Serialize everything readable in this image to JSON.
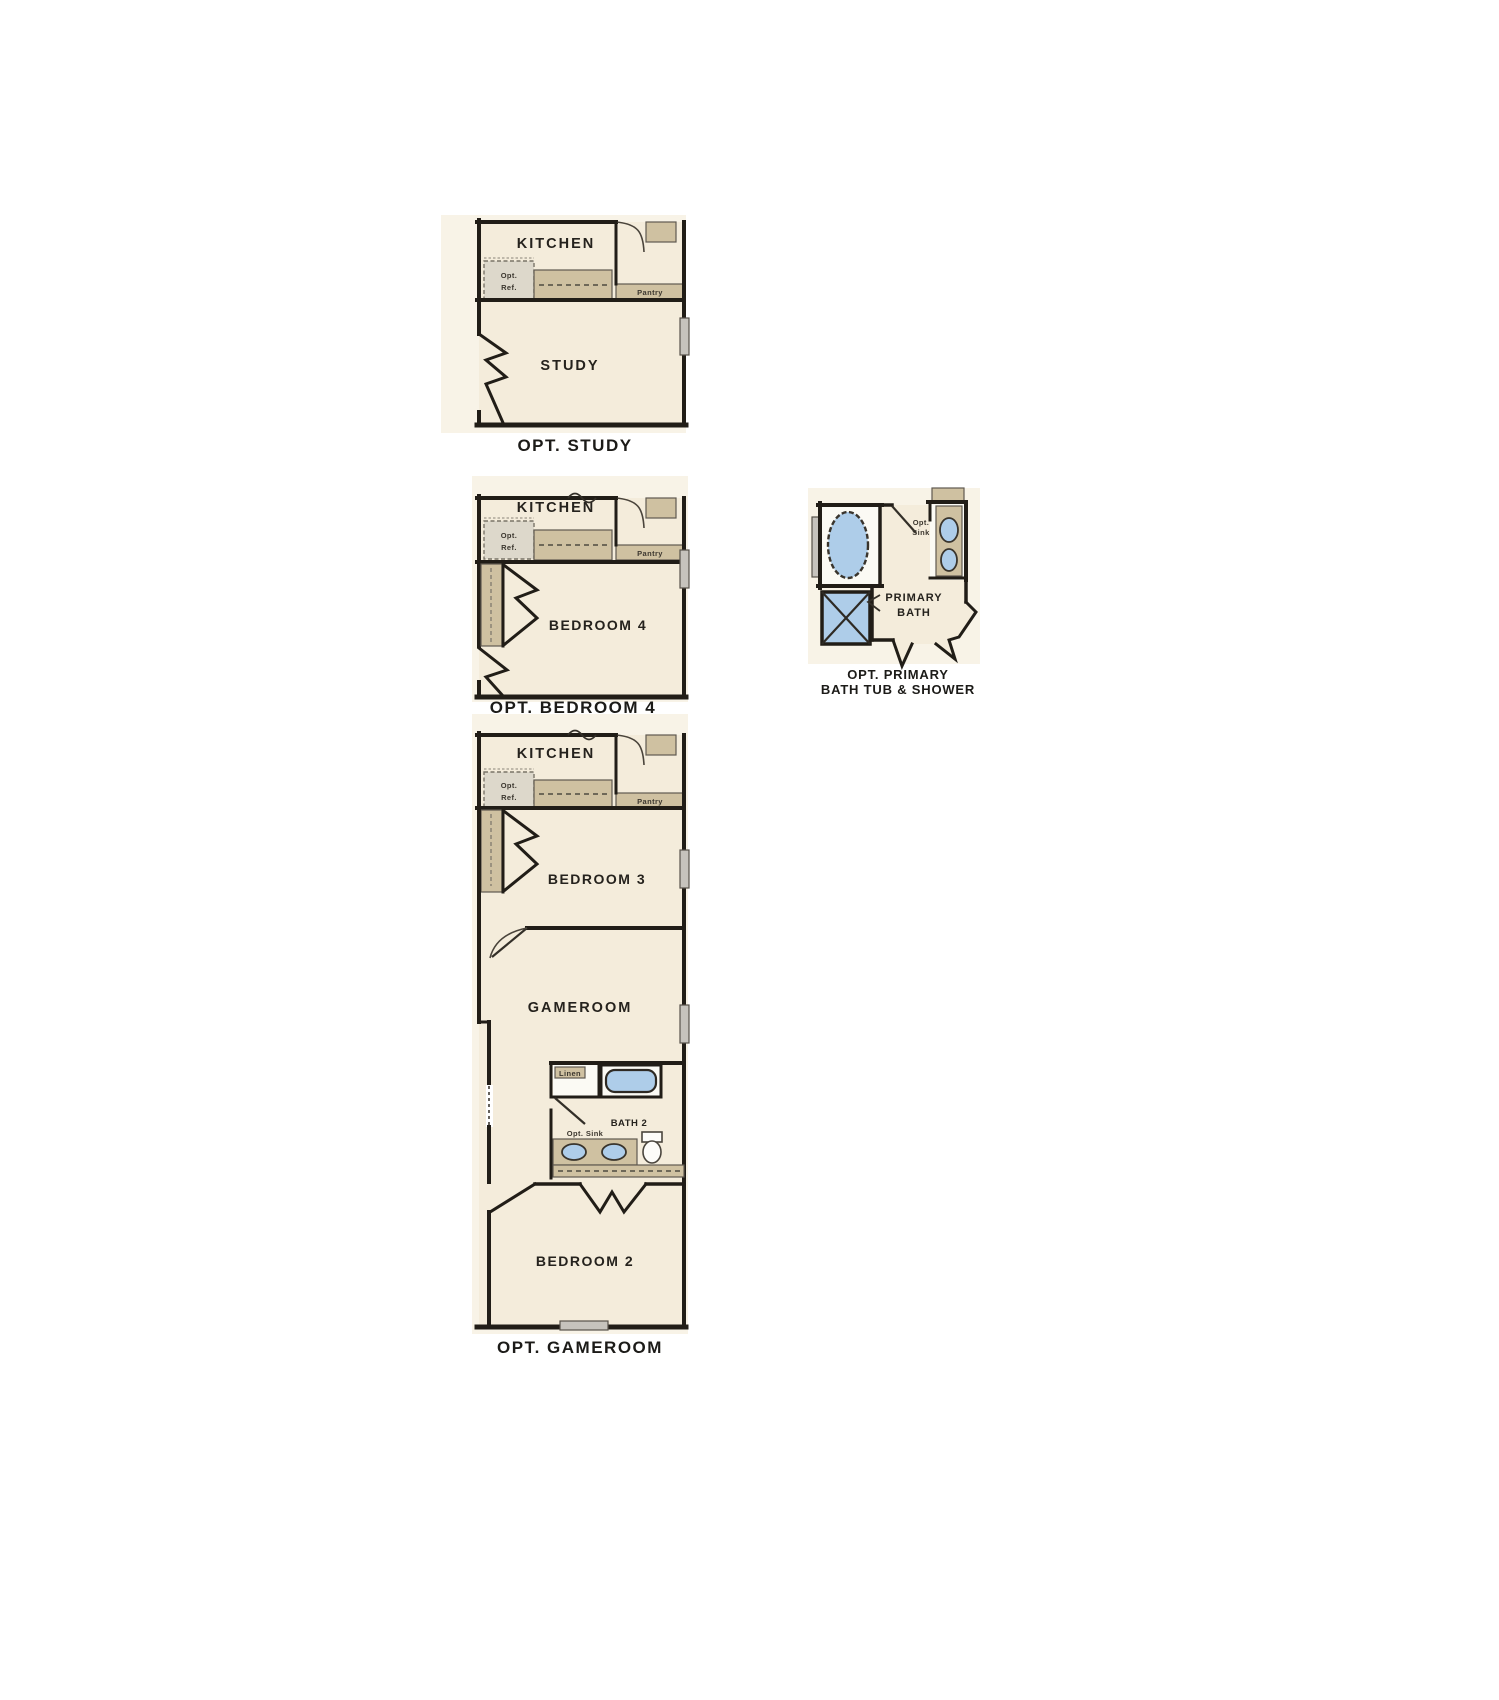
{
  "colors": {
    "paper": "#f8f3e7",
    "floor": "#f4ecdb",
    "wall": "#211d17",
    "counter": "#cfc1a1",
    "fixture": "#aecde9",
    "window": "#c6c3bd",
    "ink": "#25221d"
  },
  "plans": {
    "study": {
      "caption": "OPT. STUDY",
      "kitchen_label": "KITCHEN",
      "room_label": "STUDY",
      "ref_line1": "Opt.",
      "ref_line2": "Ref.",
      "pantry_label": "Pantry"
    },
    "bedroom4": {
      "caption": "OPT. BEDROOM 4",
      "kitchen_label": "KITCHEN",
      "room_label": "BEDROOM 4",
      "ref_line1": "Opt.",
      "ref_line2": "Ref.",
      "pantry_label": "Pantry"
    },
    "primary_bath": {
      "caption_line1": "OPT. PRIMARY",
      "caption_line2": "BATH TUB & SHOWER",
      "label_line1": "PRIMARY",
      "label_line2": "BATH",
      "sink_line1": "Opt.",
      "sink_line2": "Sink"
    },
    "gameroom": {
      "caption": "OPT. GAMEROOM",
      "kitchen_label": "KITCHEN",
      "bedroom3_label": "BEDROOM 3",
      "gameroom_label": "GAMEROOM",
      "bath2_label": "BATH 2",
      "bedroom2_label": "BEDROOM 2",
      "linen_label": "Linen",
      "opt_sink_label": "Opt. Sink",
      "ref_line1": "Opt.",
      "ref_line2": "Ref.",
      "pantry_label": "Pantry"
    }
  }
}
